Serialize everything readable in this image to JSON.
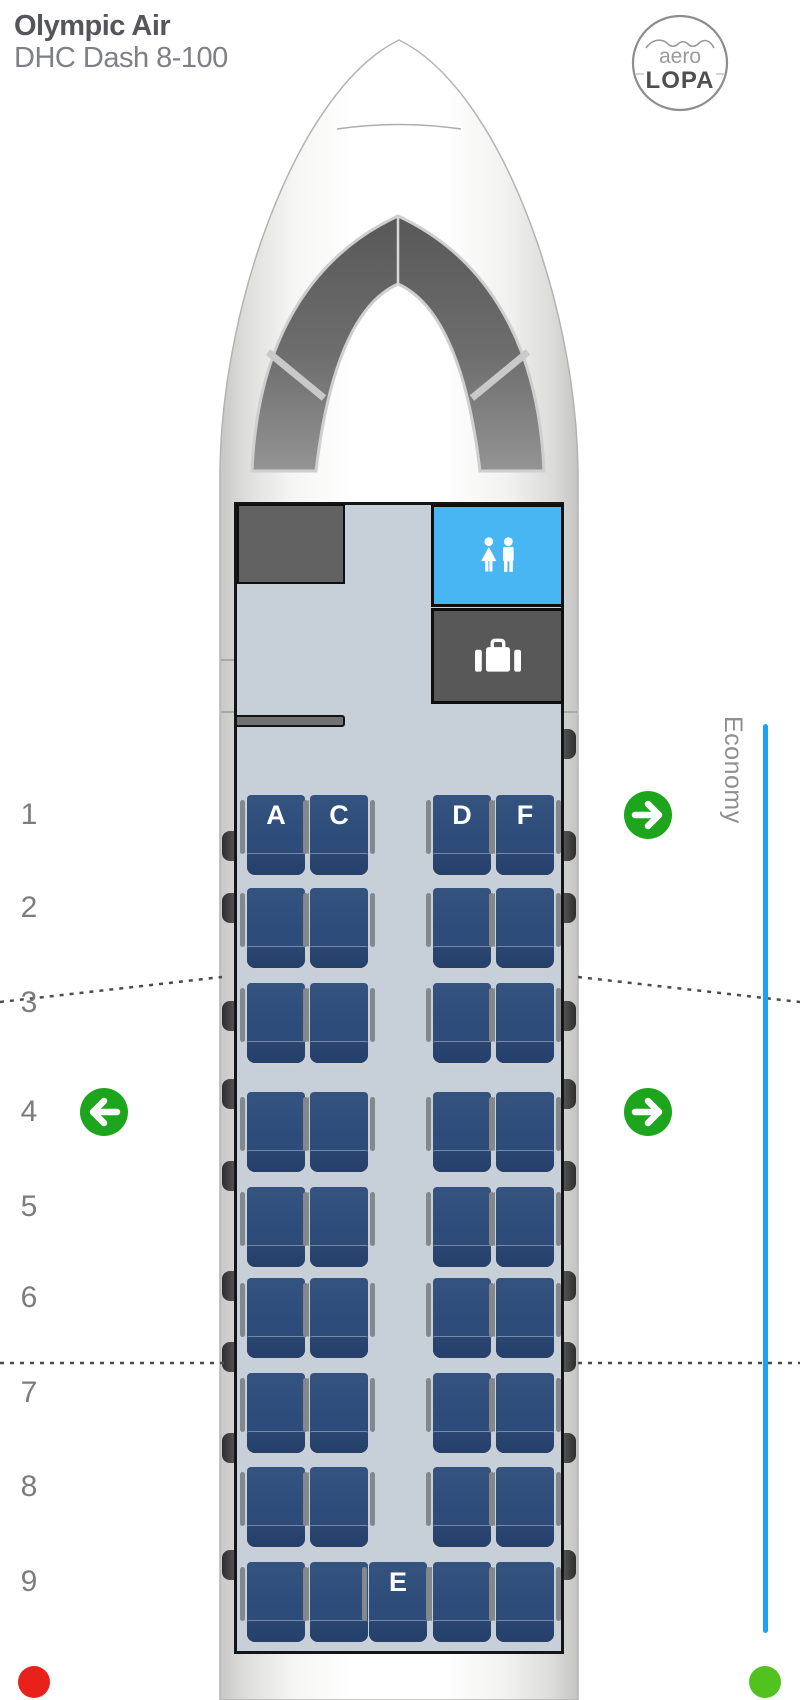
{
  "header": {
    "airline": "Olympic Air",
    "aircraft": "DHC Dash 8-100"
  },
  "logo": {
    "top_text": "aero",
    "bottom_text": "LOPA"
  },
  "cabin_class": {
    "label": "Economy"
  },
  "facilities": {
    "lavatory_icon": "male-female-icon",
    "storage_icon": "suitcase-icon"
  },
  "seat_map": {
    "columns": [
      "A",
      "C",
      "D",
      "F"
    ],
    "rows": [
      {
        "number": "1",
        "seats": [
          {
            "col": "A",
            "label": "A"
          },
          {
            "col": "C",
            "label": "C"
          },
          {
            "col": "D",
            "label": "D"
          },
          {
            "col": "F",
            "label": "F"
          }
        ]
      },
      {
        "number": "2",
        "seats": [
          {
            "col": "A"
          },
          {
            "col": "C"
          },
          {
            "col": "D"
          },
          {
            "col": "F"
          }
        ]
      },
      {
        "number": "3",
        "seats": [
          {
            "col": "A"
          },
          {
            "col": "C"
          },
          {
            "col": "D"
          },
          {
            "col": "F"
          }
        ]
      },
      {
        "number": "4",
        "seats": [
          {
            "col": "A"
          },
          {
            "col": "C"
          },
          {
            "col": "D"
          },
          {
            "col": "F"
          }
        ]
      },
      {
        "number": "5",
        "seats": [
          {
            "col": "A"
          },
          {
            "col": "C"
          },
          {
            "col": "D"
          },
          {
            "col": "F"
          }
        ]
      },
      {
        "number": "6",
        "seats": [
          {
            "col": "A"
          },
          {
            "col": "C"
          },
          {
            "col": "D"
          },
          {
            "col": "F"
          }
        ]
      },
      {
        "number": "7",
        "seats": [
          {
            "col": "A"
          },
          {
            "col": "C"
          },
          {
            "col": "D"
          },
          {
            "col": "F"
          }
        ]
      },
      {
        "number": "8",
        "seats": [
          {
            "col": "A"
          },
          {
            "col": "C"
          },
          {
            "col": "D"
          },
          {
            "col": "F"
          }
        ]
      },
      {
        "number": "9",
        "seats": [
          {
            "col": "A"
          },
          {
            "col": "C"
          },
          {
            "col": "E",
            "label": "E"
          },
          {
            "col": "D"
          },
          {
            "col": "F"
          }
        ]
      }
    ]
  },
  "exits": [
    {
      "row": "1",
      "side": "right"
    },
    {
      "row": "4",
      "side": "left"
    },
    {
      "row": "4",
      "side": "right"
    }
  ],
  "colors": {
    "seat_navy": "#2e4c79",
    "lavatory_blue": "#47b6f2",
    "exit_green": "#1ea51e",
    "economy_line_blue": "#1da1f2",
    "nav_light_red": "#e8221a",
    "nav_light_green": "#52c21f"
  }
}
